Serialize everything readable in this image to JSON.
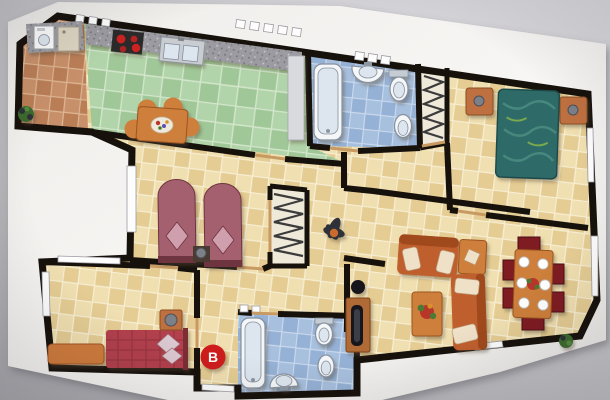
{
  "marker": {
    "label": "B",
    "bg": "#ce1f1f",
    "fg": "#ffffff"
  },
  "palette": {
    "bg_left": "#b0afb4",
    "bg_right": "#dcdbde",
    "paper": "#f4f3f1",
    "wall": "#17110c",
    "tile_cream_a": "#f0dfb0",
    "tile_cream_b": "#e5cc93",
    "tile_cream_grout": "#f9f1da",
    "tile_green_a": "#b2d4aa",
    "tile_green_b": "#a0c797",
    "tile_green_grout": "#d7e9d1",
    "tile_terra_a": "#c8906a",
    "tile_terra_b": "#ba7e57",
    "tile_blue_a": "#a7c0de",
    "tile_blue_b": "#95b1d5",
    "tile_blue_grout": "#cfddf0",
    "tile_terra_grout": "#e0bd9a",
    "granite": "#9b9ba1",
    "granite_speck_dark": "#6f6f75",
    "granite_speck_light": "#c9c9ce",
    "closet_floor": "#efe9da",
    "window": "#fdfdfd",
    "threshold": "#c89a62",
    "hanger": "#3b3b3b",
    "fixture": "#f4f6f8",
    "fixture_inner": "#dde6ee",
    "fixture_stroke": "#87919e",
    "sofa": "#c05e2d",
    "sofa_back": "#a04a1f",
    "cushion": "#efe0c8",
    "wood": "#cd7f3b",
    "wood_dark": "#9c5520",
    "chair": "#7e1e20",
    "chair_dark": "#4c1012",
    "plate": "#ffffff",
    "bed_double": "#2d6a68",
    "bed_double_dark": "#1d4a49",
    "bed_twin": "#a5606f",
    "bed_twin_dark": "#6e3440",
    "pillow_twin": "#cf9fae",
    "bed_single": "#b2404d",
    "pillow_single": "#dcc8d0",
    "nightstand": "#bf6f3f",
    "sphere": "#7b8089",
    "stove": "#2b2b2b",
    "burner": "#cc2222",
    "sink": "#c9ccd1",
    "appliance": "#fbfbfb",
    "appliance2": "#ddd5c2",
    "plant": "#3c6b2f",
    "plant_dark": "#2e3338",
    "pot": "#c96a2d",
    "flower": "#b8352c",
    "tv": "#15151a",
    "counter_return": "#d9dade",
    "marker_bg": "#ce1f1f",
    "marker_fg": "#ffffff"
  }
}
